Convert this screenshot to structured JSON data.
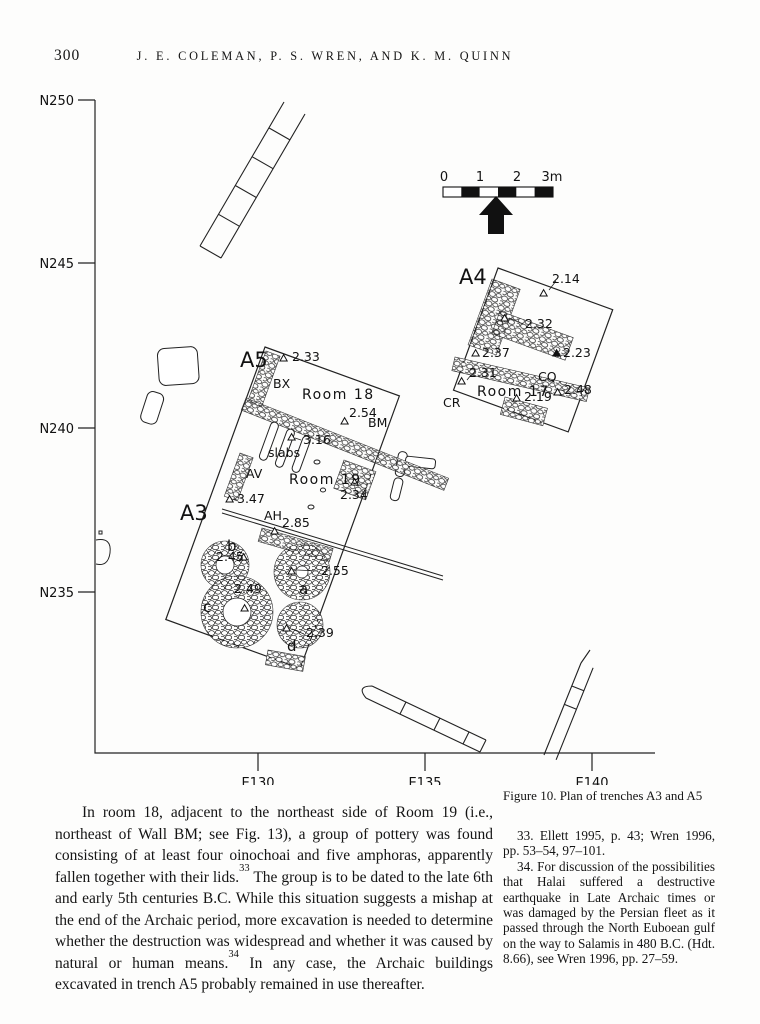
{
  "page": {
    "number": "300",
    "running_head": "J. E. COLEMAN, P. S. WREN, AND K. M. QUINN"
  },
  "figure": {
    "caption": "Figure 10. Plan of trenches A3 and A5",
    "axes": {
      "n250": "N250",
      "n245": "N245",
      "n240": "N240",
      "n235": "N235",
      "e130": "E130",
      "e135": "E135",
      "e140": "E140"
    },
    "scale": {
      "s0": "0",
      "s1": "1",
      "s2": "2",
      "s3": "3m"
    },
    "labels": {
      "a5": "A5",
      "a3": "A3",
      "a4": "A4",
      "room18": "Room 18",
      "room19": "Room 19",
      "room17": "Room 17",
      "bx": "BX",
      "bm": "BM",
      "av": "AV",
      "ah": "AH",
      "cq": "CQ",
      "cr": "CR",
      "slabs": "slabs",
      "pa": "a",
      "pb": "b",
      "pc": "c",
      "pd": "d"
    },
    "elev": {
      "e233": "2.33",
      "e254": "2.54",
      "e316": "3.16",
      "e347": "3.47",
      "e285": "2.85",
      "e234": "2.34",
      "e245": "2.45",
      "e255": "2.55",
      "e249": "2.49",
      "e239": "2.39",
      "e214": "2.14",
      "e232": "2.32",
      "e237": "2.37",
      "e223": "2.23",
      "e231": "2.31",
      "e248": "2.48",
      "e219": "2.19"
    }
  },
  "body": {
    "para": {
      "seg1": "In room 18, adjacent to the northeast side of Room 19 (i.e., northeast of Wall BM; see Fig. 13), a group of pottery was found consisting of at least four oinochoai and five amphoras, apparently fallen together with their lids.",
      "fn1": "33",
      "seg2": " The group is to be dated to the late 6th and early 5th centuries B.C. While this situation suggests a mishap at the end of the Archaic period, more excavation is needed to determine whether the destruction was widespread and whether it was caused by natural or human means.",
      "fn2": "34",
      "seg3": " In any case, the Archaic buildings excavated in trench A5 probably remained in use thereafter."
    }
  },
  "footnotes": {
    "n33": "33. Ellett 1995, p. 43; Wren 1996, pp. 53–54, 97–101.",
    "n34": "34. For discussion of the possibilities that Halai suffered a destructive earthquake in Late Archaic times or was damaged by the Persian fleet as it passed through the North Euboean gulf on the way to Salamis in 480 B.C. (Hdt. 8.66), see Wren 1996, pp. 27–59."
  }
}
